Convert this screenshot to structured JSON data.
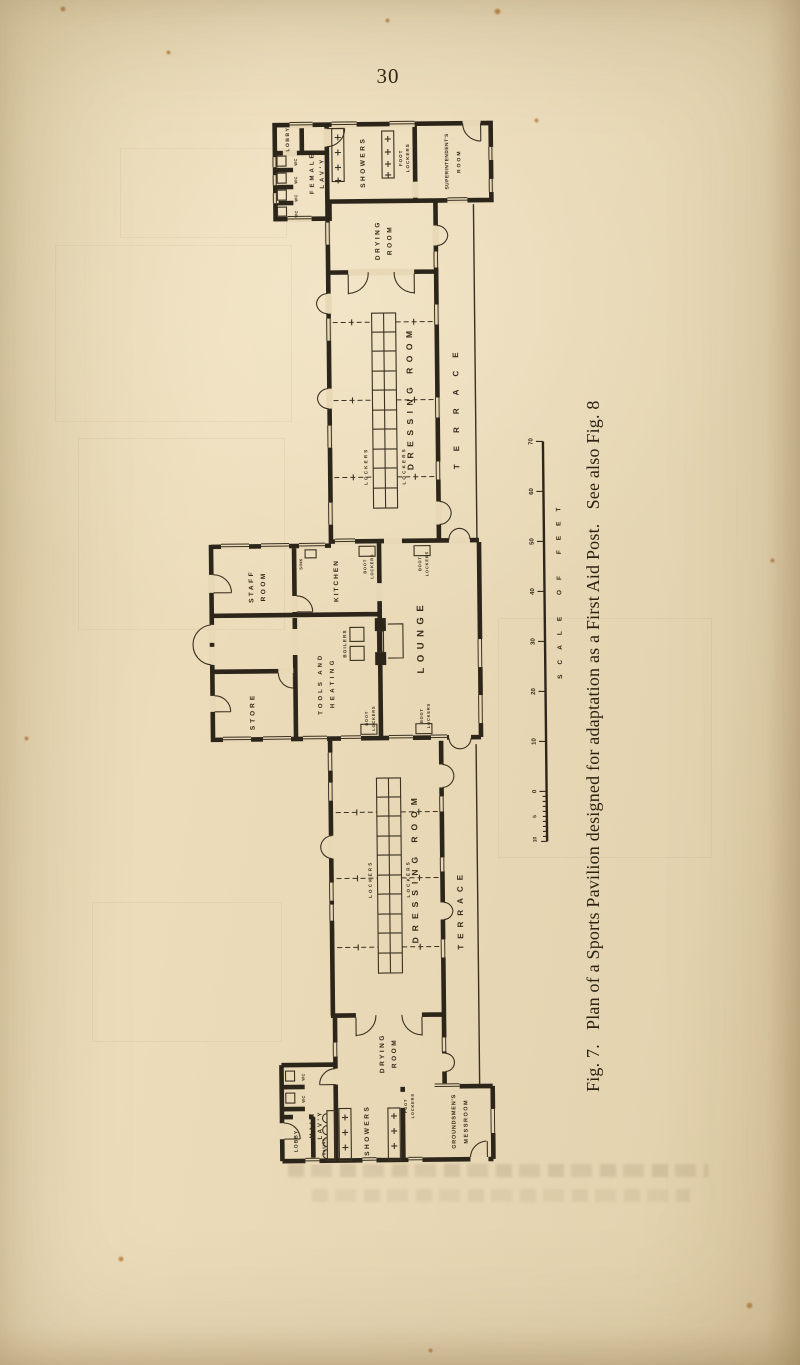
{
  "page": {
    "number": "30",
    "caption": "Fig. 7.   Plan of a Sports Pavilion designed for adaptation as a First Aid Post.   See also Fig. 8"
  },
  "plan": {
    "rooms": {
      "lobby_top": "LOBBY",
      "wc": "WC",
      "female_lav_l1": "FEMALE",
      "female_lav_l2": "LAV'Y",
      "showers_top": "SHOWERS",
      "foot_lockers_l1": "FOOT",
      "foot_lockers_l2": "LOCKERS",
      "superintendents_l1": "SUPERINTENDENT'S",
      "superintendents_l2": "ROOM",
      "drying_l1": "DRYING",
      "drying_l2": "ROOM",
      "dressing_room": "DRESSING ROOM",
      "lockers": "LOCKERS",
      "terrace": "TERRACE",
      "staff_l1": "STAFF",
      "staff_l2": "ROOM",
      "sink": "SINK",
      "kitchen": "KITCHEN",
      "boot_lockers_l1": "BOOT",
      "boot_lockers_l2": "LOCKERS",
      "lounge": "LOUNGE",
      "store": "STORE",
      "tools_l1": "TOOLS AND",
      "tools_l2": "HEATING",
      "boilers": "BOILERS",
      "male_lav_l1": "MALE",
      "male_lav_l2": "LAV'Y",
      "basins": "BASINS",
      "lobby_bottom": "LOBBY",
      "showers_bottom": "SHOWERS",
      "messroom_l1": "GROUNDSMEN'S",
      "messroom_l2": "MESSROOM"
    },
    "scale": {
      "title": "SCALE OF FEET",
      "majors": [
        "70",
        "60",
        "50",
        "40",
        "30",
        "20",
        "10",
        "0"
      ],
      "minors": [
        "5",
        "10"
      ]
    }
  },
  "colors": {
    "paper": "#e8d8b6",
    "ink": "#2c251a"
  }
}
